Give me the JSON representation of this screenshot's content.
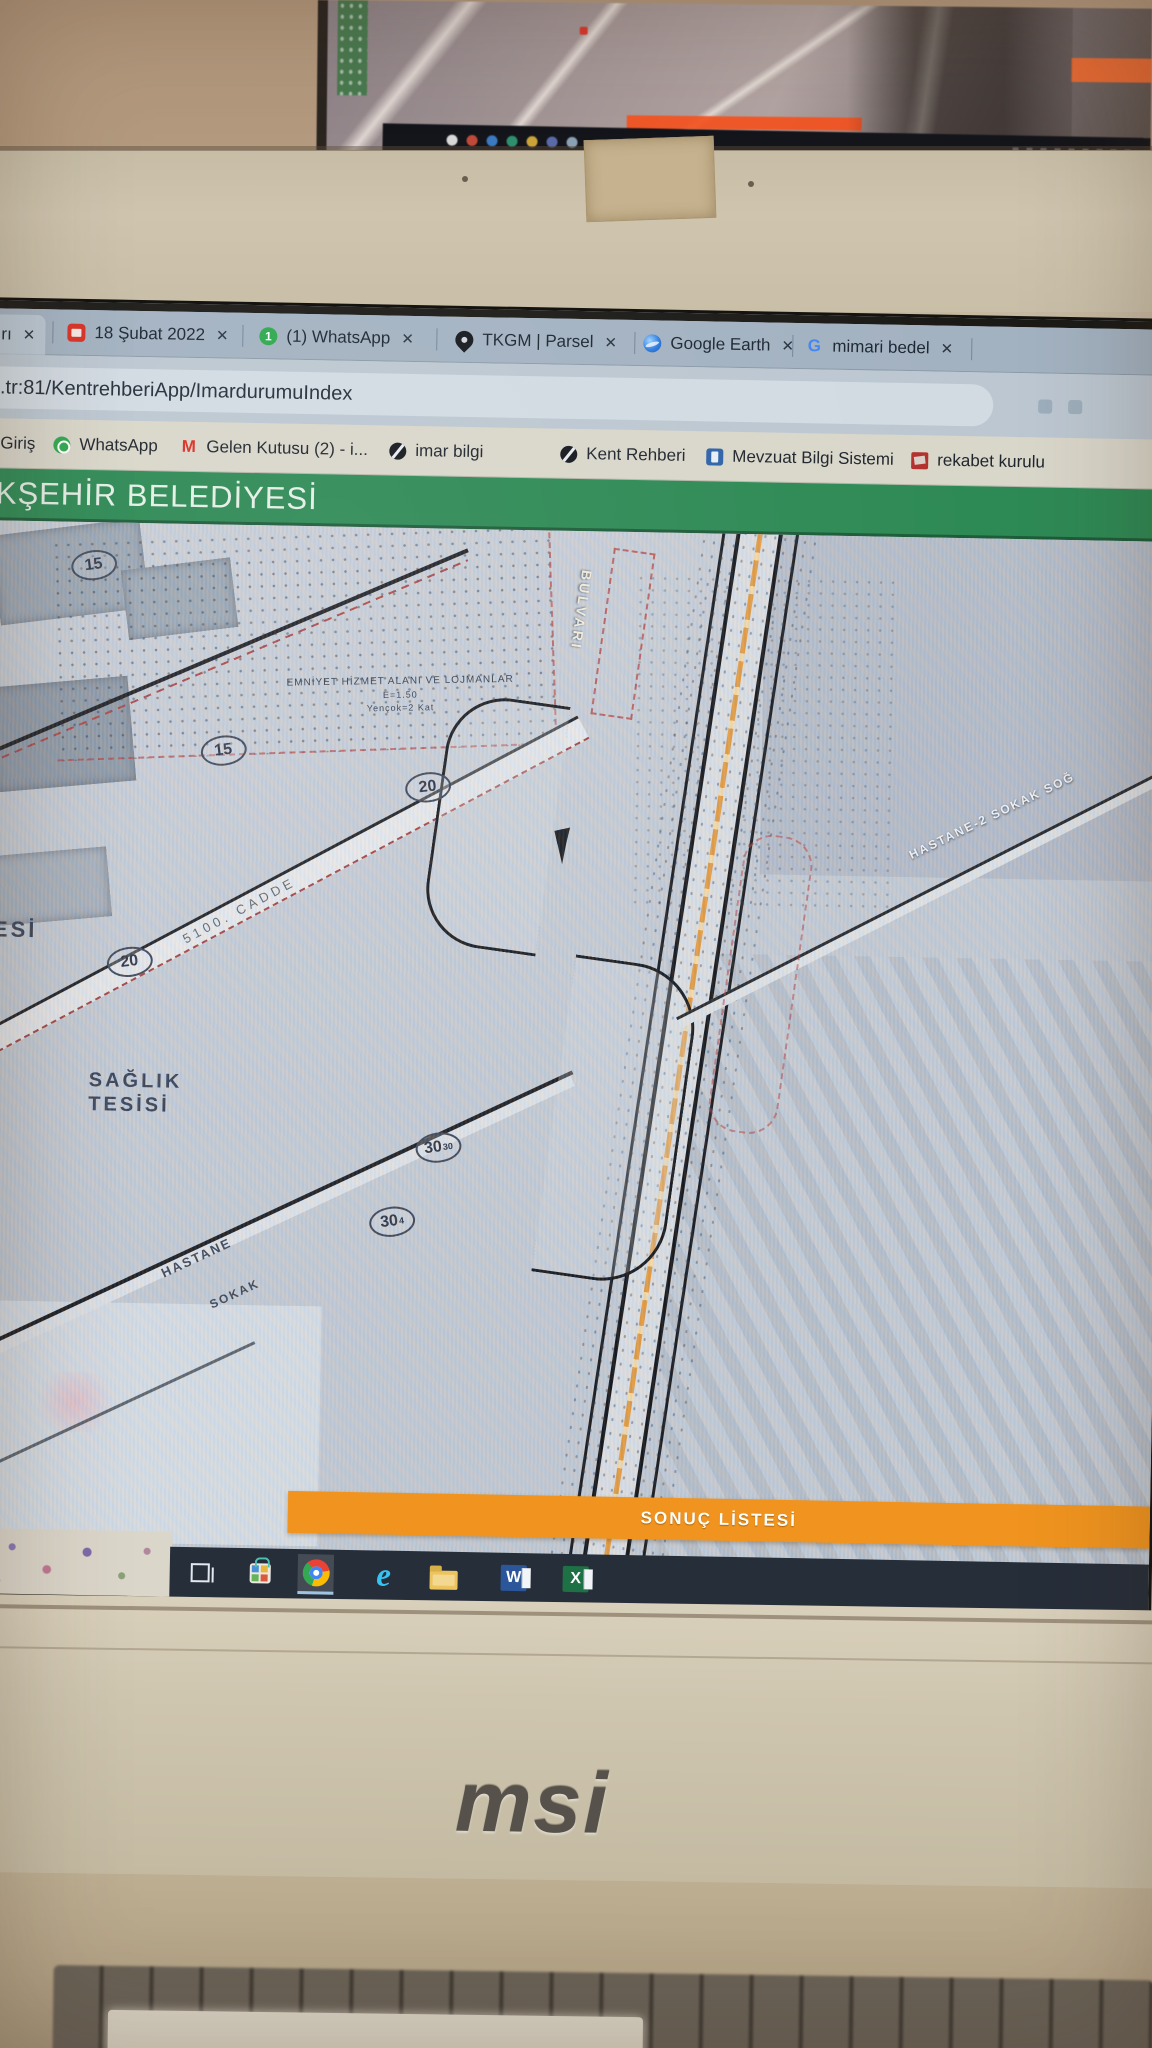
{
  "browser": {
    "tabs": [
      {
        "label": "rı"
      },
      {
        "label": "18 Şubat 2022"
      },
      {
        "label": "(1) WhatsApp",
        "badge": "1"
      },
      {
        "label": "TKGM | Parsel"
      },
      {
        "label": "Google Earth"
      },
      {
        "label": "mimari bedel",
        "icon_glyph": "G"
      }
    ],
    "close_glyph": "✕",
    "url": "el.tr:81/KentrehberiApp/ImardurumuIndex",
    "bookmarks": [
      {
        "label": "Giriş"
      },
      {
        "label": "WhatsApp"
      },
      {
        "label": "Gelen Kutusu (2) - i...",
        "icon_glyph": "M"
      },
      {
        "label": "imar bilgi"
      },
      {
        "label": "Kent Rehberi"
      },
      {
        "label": "Mevzuat Bilgi Sistemi"
      },
      {
        "label": "rekabet kurulu"
      }
    ],
    "header_title": "ÜKŞEHİR BELEDİYESİ",
    "status_text": "n",
    "result_bar_label": "SONUÇ LİSTESİ"
  },
  "map": {
    "zone_note": {
      "line1": "EMNİYET HİZMET ALANI VE LOJMANLAR",
      "line2": "E=1.50",
      "line3": "Yençok=2 Kat"
    },
    "labels": {
      "saglik_line1": "SAĞLIK",
      "saglik_line2": "TESİSİ",
      "tesi_top": "A",
      "tesi": "TESİ",
      "cadde": "5100. CADDE",
      "bulvari": "BULVARI",
      "hastane2_sokak": "HASTANE-2 SOKAK SOĞ",
      "hastane": "HASTANE",
      "sokak": "SOKAK"
    },
    "width_markers": [
      {
        "value": "15",
        "sup": ""
      },
      {
        "value": "15",
        "sup": ""
      },
      {
        "value": "20",
        "sup": ""
      },
      {
        "value": "20",
        "sup": ""
      },
      {
        "value": "30",
        "sup": "30"
      },
      {
        "value": "30",
        "sup": "4"
      }
    ],
    "colors": {
      "header_green": "#2e8a55",
      "result_bar_orange": "#f0941f",
      "road_center_orange": "#e8a84f",
      "parcel_red": "#b84444"
    }
  },
  "taskbar": {
    "icons": [
      {
        "name": "task-view"
      },
      {
        "name": "store"
      },
      {
        "name": "chrome",
        "active": true
      },
      {
        "name": "internet-explorer",
        "glyph": "e"
      },
      {
        "name": "file-explorer"
      },
      {
        "name": "word",
        "glyph": "W"
      },
      {
        "name": "excel",
        "glyph": "X"
      }
    ]
  },
  "laptop": {
    "brand_logo": "msi"
  }
}
